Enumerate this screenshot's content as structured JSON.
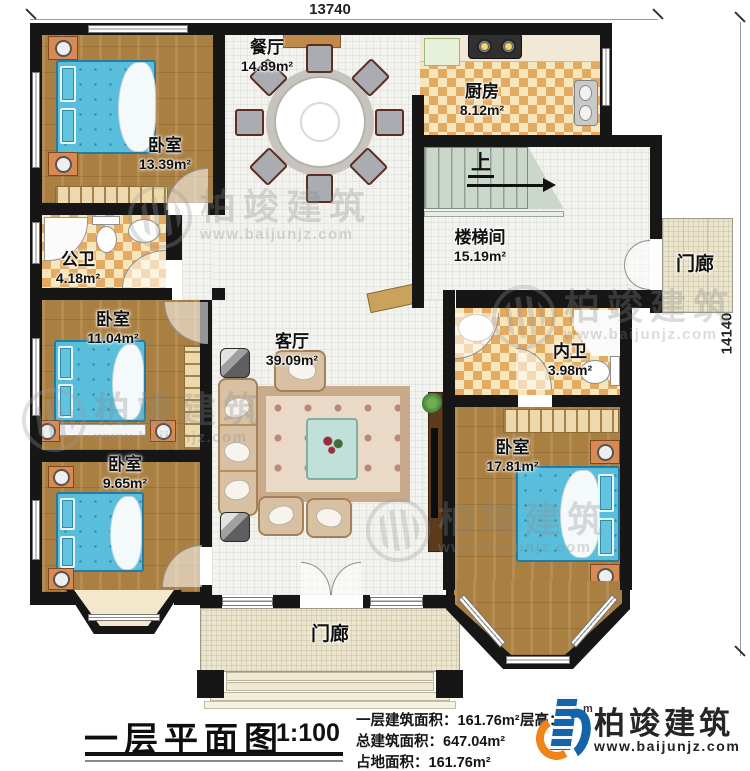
{
  "dimensions": {
    "width_label": "13740",
    "height_label": "14140"
  },
  "rooms": [
    {
      "name": "卧室",
      "area": "13.39m²"
    },
    {
      "name": "餐厅",
      "area": "14.89m²"
    },
    {
      "name": "厨房",
      "area": "8.12m²"
    },
    {
      "name": "楼梯间",
      "area": "15.19m²"
    },
    {
      "name": "门廊",
      "area": ""
    },
    {
      "name": "公卫",
      "area": "4.18m²"
    },
    {
      "name": "卧室",
      "area": "11.04m²"
    },
    {
      "name": "客厅",
      "area": "39.09m²"
    },
    {
      "name": "内卫",
      "area": "3.98m²"
    },
    {
      "name": "卧室",
      "area": "17.81m²"
    },
    {
      "name": "卧室",
      "area": "9.65m²"
    },
    {
      "name": "门廊",
      "area": ""
    }
  ],
  "stairs": {
    "up_label": "上"
  },
  "title_block": {
    "title": "一层平面图",
    "scale": "1:100",
    "stats": [
      {
        "label": "一层建筑面积：",
        "value": "161.76m²"
      },
      {
        "label": "总建筑面积：",
        "value": "647.04m²"
      },
      {
        "label": "占地面积：",
        "value": "161.76m²"
      }
    ],
    "floor_height_label": "层高：",
    "floor_height_unit": "m"
  },
  "branding": {
    "company": "柏竣建筑",
    "website": "www.baijunjz.com"
  },
  "colors": {
    "wall": "#161616",
    "wood": "#aa7f42",
    "bed": "#59bedc",
    "checker": "#e3aa62",
    "logo_blue": "#1563a8",
    "logo_orange": "#ef8418"
  }
}
